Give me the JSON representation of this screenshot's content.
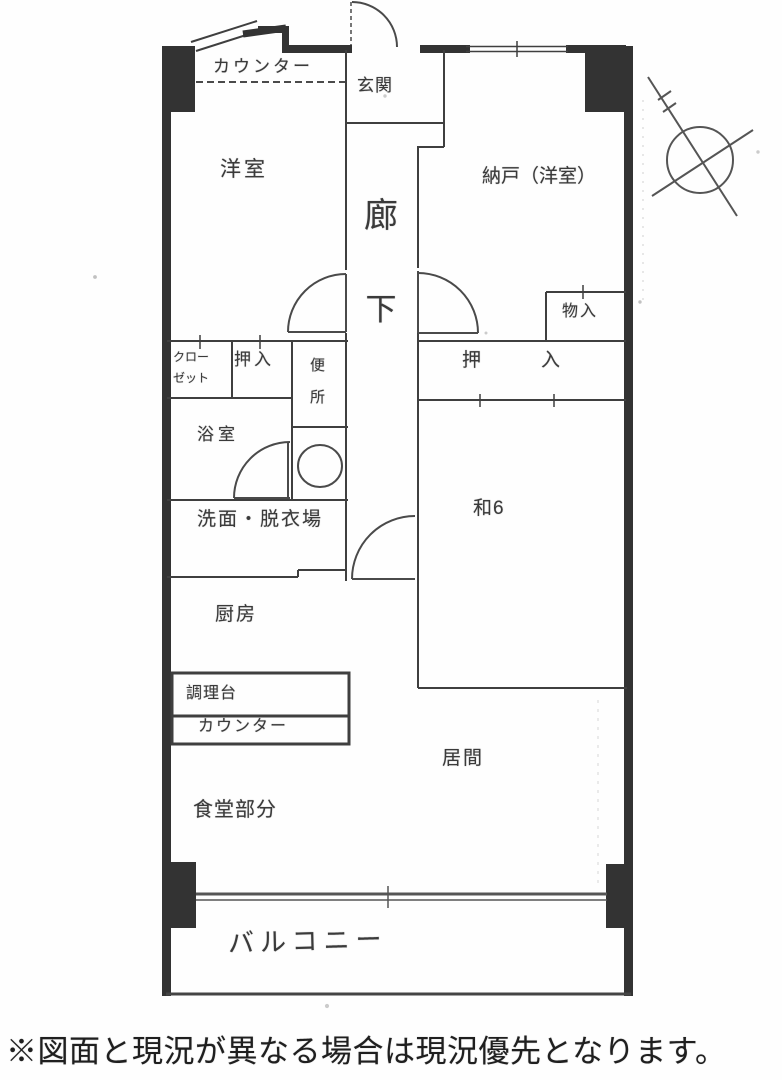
{
  "floorplan": {
    "labels": {
      "counter_top": "カウンター",
      "entrance": "玄関",
      "western_room": "洋室",
      "storage_western_room": "納戸（洋室）",
      "corridor_char1": "廊",
      "corridor_char2": "下",
      "storage_small": "物入",
      "closet_line1": "クロー",
      "closet_line2": "ゼット",
      "oshiire_hall": "押入",
      "toilet_char1": "便",
      "toilet_char2": "所",
      "bathroom": "浴室",
      "oshiire_washitsu": "押入",
      "washroom": "洗面・脱衣場",
      "japanese_room_6": "和6",
      "kitchen": "厨房",
      "cooking_counter": "調理台",
      "counter_kitchen": "カウンター",
      "living_room": "居間",
      "dining_area": "食堂部分",
      "balcony": "バルコニー"
    },
    "symbols": [
      "north-arrow-compass",
      "toilet-bowl",
      "door-swing-arc",
      "window-double-line"
    ],
    "colors": {
      "paper": "#fefefe",
      "wall": "#333333",
      "line": "#3f3f3f",
      "arc": "#4a4a4a",
      "text": "#3a3a3a"
    }
  },
  "footer": {
    "note": "※図面と現況が異なる場合は現況優先となります。"
  }
}
